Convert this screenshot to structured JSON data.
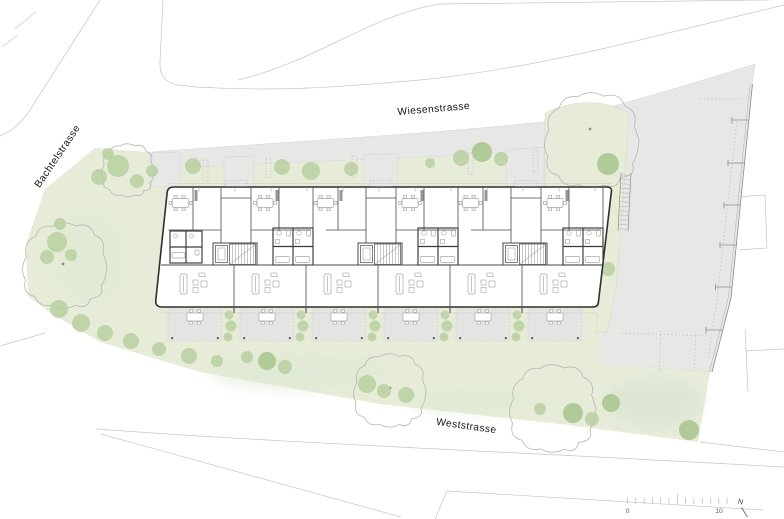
{
  "plan": {
    "street_labels": {
      "top": "Wiesenstrasse",
      "left": "Bachtelstrasse",
      "bottom": "Weststrasse"
    },
    "scale_bar": {
      "start": "0",
      "end": "10",
      "tick_count": 13
    },
    "north_arrow": {
      "label": "N"
    },
    "colors": {
      "lawn_green": "#e7ecd9",
      "tree_green": "#b9d0a0",
      "paving_gray": "#e7e7e5",
      "terrace_gray": "#e4e4e2",
      "building_wall": "#2f2f2d",
      "parcel_line": "#c6c6c4"
    }
  }
}
